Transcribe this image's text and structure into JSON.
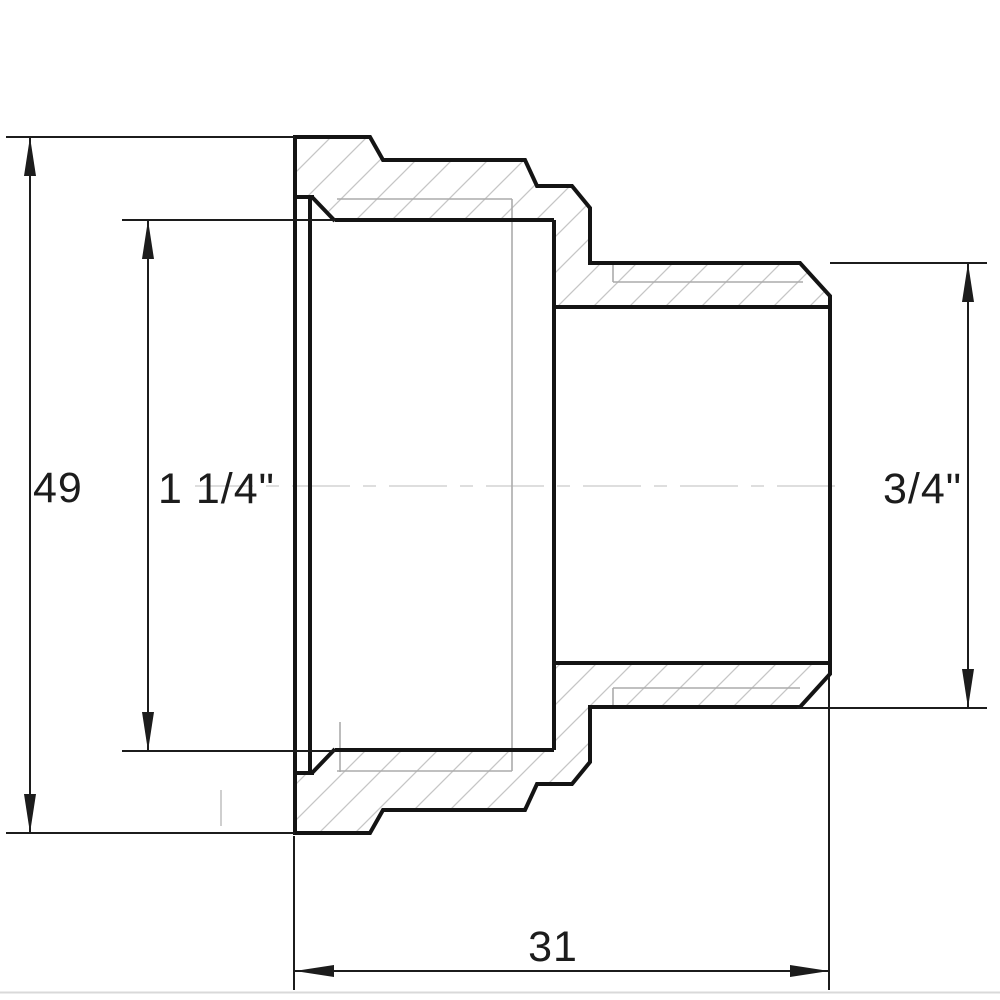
{
  "drawing": {
    "type": "technical-section-drawing",
    "subject": "threaded-reducing-adapter-fitting",
    "dimensions": {
      "overall_height": {
        "label": "49"
      },
      "female_thread": {
        "label": "1 1/4\""
      },
      "male_thread": {
        "label": "3/4\""
      },
      "male_end_length": {
        "label": "31"
      }
    },
    "colors": {
      "outline": "#141414",
      "dimension_lines": "#1c1c1c",
      "thread_thin_lines": "#ababab",
      "hatching": "#c6c6c6",
      "centerline": "#dedede",
      "bottom_border": "#d9d9d9",
      "background": "#ffffff"
    }
  }
}
